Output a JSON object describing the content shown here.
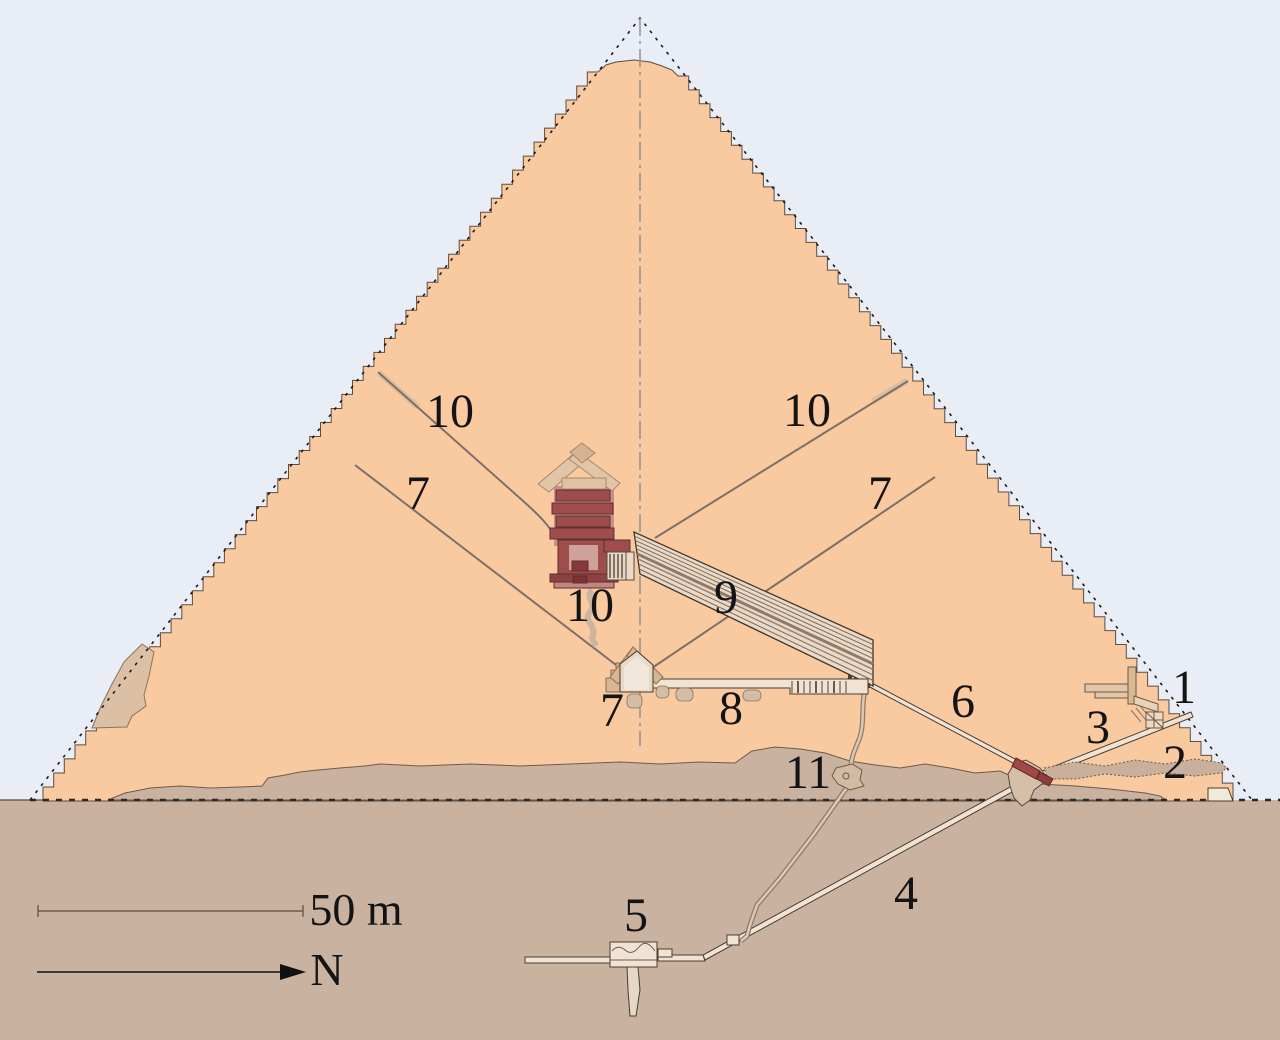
{
  "scene": {
    "type": "pyramid-cross-section-diagram",
    "feature_labels": {
      "entrance": "1",
      "robbers_tunnel": "2",
      "descending_passage_upper": "3",
      "descending_passage_lower": "4",
      "subterranean_chamber": "5",
      "ascending_passage": "6",
      "queen_shaft_north": "7",
      "queen_shaft_south": "7",
      "queen_chamber": "7",
      "horizontal_passage": "8",
      "grand_gallery": "9",
      "king_shaft_north": "10",
      "king_shaft_south": "10",
      "king_chamber": "10",
      "well_shaft": "11"
    },
    "scale_bar": {
      "label": "50 m"
    },
    "compass": {
      "label": "N"
    },
    "colors": {
      "sky": "#e9edf6",
      "masonry": "#f9c9a0",
      "ground": "#c9b2a0",
      "casing_tan": "#e0c4a9",
      "passage_fill": "#f0e3d3",
      "gallery_fill": "#ead9c7",
      "chamber_red": "#9f4c4c",
      "chamber_red_light": "#c98f8a",
      "granite_plug_red": "#a34646",
      "outline": "#463a2e",
      "label_color": "#141414"
    }
  }
}
